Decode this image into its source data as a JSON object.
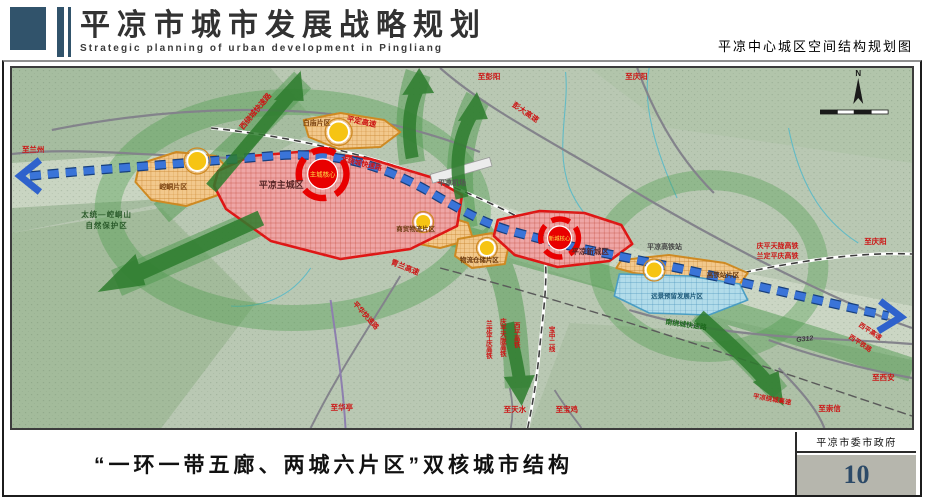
{
  "header": {
    "title": "平凉市城市发展战略规划",
    "subtitle_en": "Strategic planning of urban development in Pingliang",
    "map_title": "平凉中心城区空间结构规划图"
  },
  "footer": {
    "caption": "“一环一带五廊、两城六片区”双核城市结构",
    "agency": "平凉市委市政府",
    "page_number": "10"
  },
  "map": {
    "compass_n": "N",
    "cities": {
      "main_city": "平凉主城区",
      "new_city": "平凉新城区"
    },
    "cores": {
      "main_core": "主城核心",
      "new_core": "新城核心"
    },
    "districts": {
      "kongtong": "崆峒片区",
      "baimiao": "白庙片区",
      "trade_logistics": "商贸物流片区",
      "logistics_storage": "物流仓储片区",
      "hsr_district": "高铁站片区",
      "reserved": "远景预留发展片区"
    },
    "facilities": {
      "airport": "平凉机场",
      "hsr_station": "平凉高铁站"
    },
    "nature_reserve": {
      "line1": "太统—崆峒山",
      "line2": "自然保护区"
    },
    "roads": {
      "xi_ring": "西绕城快速路",
      "bei_ring": "北绕城快速路",
      "nan_ring": "南绕城快速路",
      "pingding_expwy": "平定高速",
      "pengda_expwy": "彭大高速",
      "qinglan_expwy": "青兰高速",
      "pinghua_expwy": "平华快速路",
      "pl_ring_expwy": "平凉绕城高速",
      "xiping_expwy": "西平高速",
      "g312": "G312"
    },
    "railways": {
      "qptl_hsr": "庆平天陇高铁",
      "ldpq_hsr": "兰定平庆高铁",
      "xiping_hsr": "西平高铁",
      "baozhong_line2": "宝中二线",
      "xiping_rail": "西平铁路"
    },
    "directions": {
      "lanzhou": "至兰州",
      "pengyang": "至彭阳",
      "qingyang": "至庆阳",
      "huating": "至华亭",
      "tianshui": "至天水",
      "baoji": "至宝鸡",
      "chongxin": "至崇信",
      "xian": "至西安"
    },
    "colors": {
      "header_accent": "#31536b",
      "city_fill": "#efa6a6",
      "city_border": "#e01414",
      "district_fill": "#f2c88c",
      "district_border": "#cf8a22",
      "reserved_fill": "#b2dcea",
      "corridor_green": "#2e7d2e",
      "axis_blue": "#2f62cc",
      "page_number_blue": "#2c4a68"
    }
  }
}
